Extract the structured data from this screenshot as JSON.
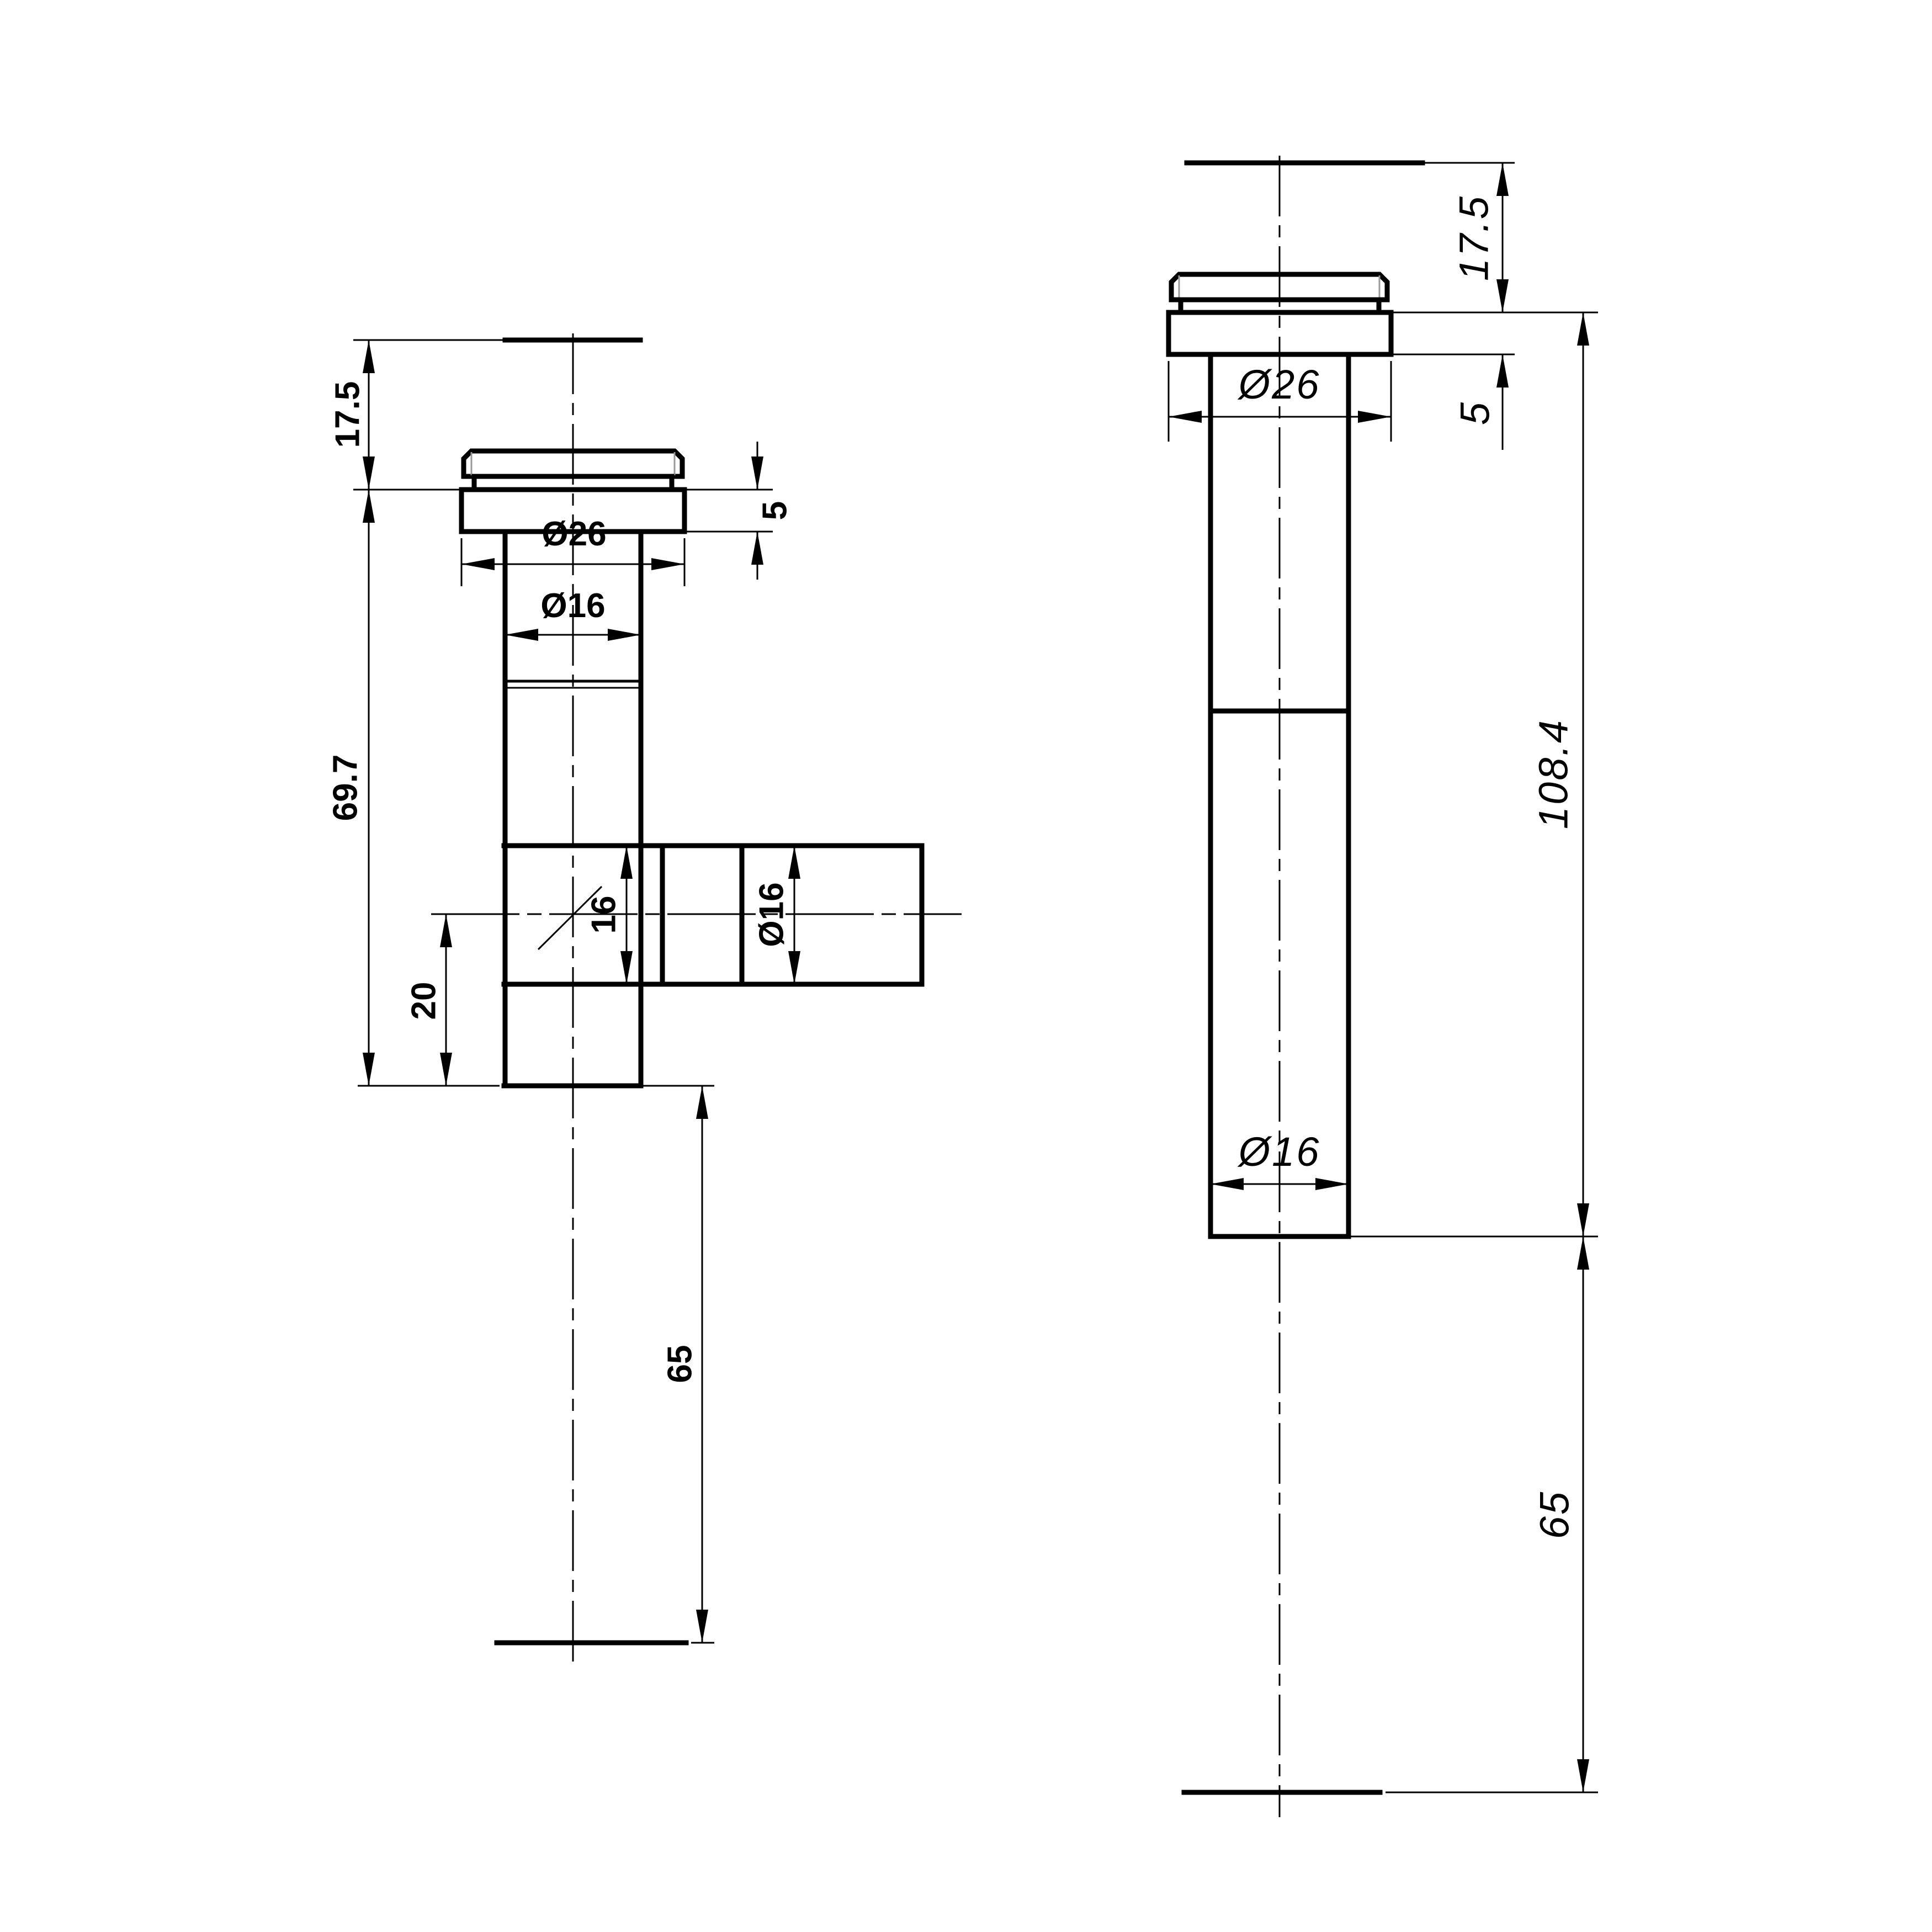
{
  "drawing": {
    "background_color": "#ffffff",
    "line_color": "#000000",
    "views": {
      "front": {
        "title": "front-view-T-fitting",
        "label_style": "bold-sans",
        "dims": {
          "cap_height": "17.5",
          "flange_thickness": "5",
          "flange_diameter": "Ø26",
          "stem_diameter": "Ø16",
          "stem_length": "69.7",
          "branch_bore": "16",
          "branch_diameter": "Ø16",
          "branch_offset": "20",
          "tail_length": "65"
        }
      },
      "side": {
        "title": "side-view-straight",
        "label_style": "cad-italic",
        "dims": {
          "cap_height": "17.5",
          "flange_thickness": "5",
          "flange_diameter": "Ø26",
          "overall_length": "108.4",
          "stem_diameter": "Ø16",
          "tail_length": "65"
        }
      }
    }
  }
}
